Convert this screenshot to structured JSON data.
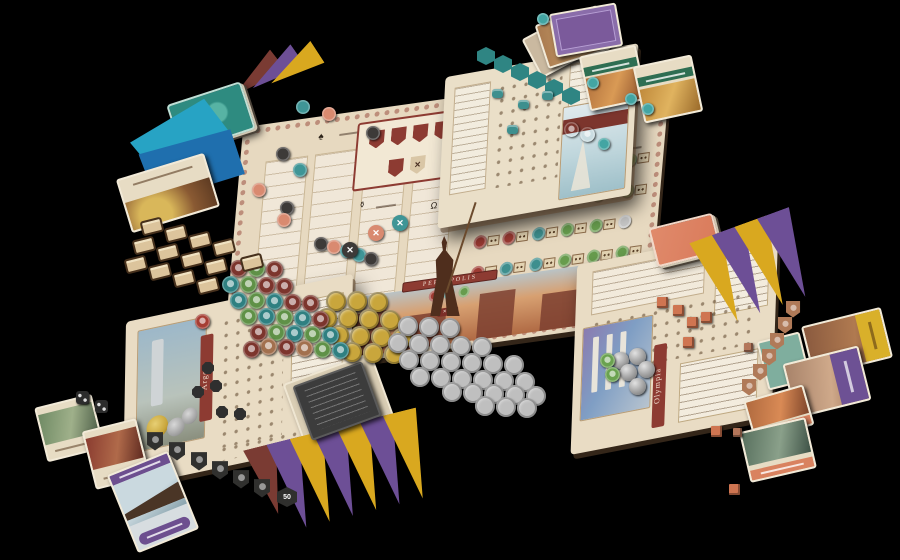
{
  "scene": {
    "background": "#000000",
    "description": "tabletop photo of a strategy board game with main board, three city player boards, cards, pennants, coins and tokens"
  },
  "main_board": {
    "banner_label": "PERSEPOLIS",
    "multiplier_label": "×5",
    "shield_slots": 6,
    "icons": {
      "column": "♠",
      "tax": "⚱",
      "debts": "Ω",
      "expense": "✕"
    },
    "colors": {
      "red": "#9e3b33",
      "teal": "#3e8f8e",
      "green": "#679c4d",
      "silver": "#c6c6c6"
    },
    "market": {
      "rows": [
        [
          "r",
          "r",
          "s",
          "t",
          "_",
          "_"
        ],
        [
          "r",
          "r",
          "t",
          "t",
          "s",
          "g"
        ],
        [
          "r",
          "s",
          "t",
          "t",
          "g",
          "g"
        ],
        [
          "r",
          "r",
          "t",
          "g",
          "g",
          "s"
        ],
        [
          "r",
          "t",
          "t",
          "g",
          "g",
          "g"
        ]
      ]
    }
  },
  "player_boards": {
    "argos": {
      "name": "Argos",
      "banner_color": "#8d3b32",
      "piece_color": "#2f2f2f"
    },
    "olympia": {
      "name": "Olympia",
      "banner_color": "#8d3b32",
      "piece_color": "#cf7551"
    },
    "harbor": {
      "name": "",
      "piece_color": "#3e8f8e"
    }
  },
  "pennants": {
    "palette": {
      "purple": "#6d4f96",
      "yellow": "#d9a81f",
      "maroon": "#7a3b33"
    },
    "bottom": [
      "maroon",
      "purple",
      "yellow",
      "purple",
      "yellow",
      "purple",
      "yellow"
    ],
    "right": [
      "yellow",
      "purple",
      "yellow",
      "purple"
    ],
    "stack_top_left": [
      "maroon",
      "purple",
      "yellow"
    ]
  },
  "clusters": [
    {
      "name": "gold-coin",
      "shape": "coin",
      "size": 20,
      "color": "#c9a63c",
      "items": [
        [
          336,
          301
        ],
        [
          357,
          301
        ],
        [
          378,
          302
        ],
        [
          327,
          318
        ],
        [
          348,
          318
        ],
        [
          369,
          319
        ],
        [
          390,
          320
        ],
        [
          339,
          335
        ],
        [
          360,
          336
        ],
        [
          381,
          337
        ],
        [
          402,
          338
        ],
        [
          352,
          352
        ],
        [
          373,
          353
        ],
        [
          394,
          354
        ]
      ]
    },
    {
      "name": "silver-coin",
      "shape": "coin",
      "size": 20,
      "color": "#bfbfbf",
      "items": [
        [
          408,
          326
        ],
        [
          429,
          327
        ],
        [
          450,
          328
        ],
        [
          398,
          343
        ],
        [
          419,
          344
        ],
        [
          440,
          345
        ],
        [
          461,
          346
        ],
        [
          482,
          347
        ],
        [
          409,
          360
        ],
        [
          430,
          361
        ],
        [
          451,
          362
        ],
        [
          472,
          363
        ],
        [
          493,
          364
        ],
        [
          514,
          365
        ],
        [
          420,
          377
        ],
        [
          441,
          378
        ],
        [
          462,
          379
        ],
        [
          483,
          380
        ],
        [
          504,
          381
        ],
        [
          525,
          382
        ],
        [
          452,
          392
        ],
        [
          473,
          393
        ],
        [
          494,
          394
        ],
        [
          515,
          395
        ],
        [
          536,
          396
        ],
        [
          485,
          406
        ],
        [
          506,
          407
        ],
        [
          527,
          408
        ]
      ]
    },
    {
      "name": "helmet-token",
      "shape": "disc glyphed",
      "size": 17,
      "colors": {
        "m": "#7c352d",
        "t": "#2f8081",
        "g": "#5f9147",
        "c": "#a2704e"
      },
      "items": [
        [
          238,
          268,
          "m"
        ],
        [
          256,
          268,
          "g"
        ],
        [
          274,
          269,
          "m"
        ],
        [
          230,
          284,
          "t"
        ],
        [
          248,
          284,
          "g"
        ],
        [
          266,
          285,
          "m"
        ],
        [
          284,
          286,
          "m"
        ],
        [
          238,
          300,
          "t"
        ],
        [
          256,
          300,
          "g"
        ],
        [
          274,
          301,
          "t"
        ],
        [
          292,
          302,
          "m"
        ],
        [
          310,
          303,
          "m"
        ],
        [
          248,
          316,
          "g"
        ],
        [
          266,
          316,
          "t"
        ],
        [
          284,
          317,
          "g"
        ],
        [
          302,
          318,
          "t"
        ],
        [
          320,
          319,
          "m"
        ],
        [
          258,
          332,
          "m"
        ],
        [
          276,
          332,
          "g"
        ],
        [
          294,
          333,
          "t"
        ],
        [
          312,
          334,
          "g"
        ],
        [
          330,
          335,
          "t"
        ],
        [
          286,
          347,
          "m"
        ],
        [
          304,
          348,
          "c"
        ],
        [
          322,
          349,
          "g"
        ],
        [
          340,
          350,
          "t"
        ],
        [
          268,
          346,
          "c"
        ],
        [
          251,
          349,
          "m"
        ]
      ]
    },
    {
      "name": "scroll-token",
      "shape": "scroll",
      "w": 22,
      "h": 15,
      "color": "#dcc49c",
      "items": [
        [
          152,
          226
        ],
        [
          176,
          233
        ],
        [
          200,
          240
        ],
        [
          224,
          247
        ],
        [
          144,
          245
        ],
        [
          168,
          252
        ],
        [
          192,
          259
        ],
        [
          216,
          266
        ],
        [
          136,
          264
        ],
        [
          160,
          271
        ],
        [
          184,
          278
        ],
        [
          208,
          285
        ],
        [
          252,
          262
        ]
      ]
    },
    {
      "name": "track-disc",
      "shape": "disc",
      "size": 14,
      "colors": {
        "t": "#3f9596",
        "s": "#d98a70",
        "k": "#3d3a38"
      },
      "items": [
        [
          303,
          107,
          "t"
        ],
        [
          329,
          114,
          "s"
        ],
        [
          373,
          133,
          "k"
        ],
        [
          283,
          154,
          "k"
        ],
        [
          300,
          170,
          "t"
        ],
        [
          259,
          190,
          "s"
        ],
        [
          287,
          208,
          "k"
        ],
        [
          284,
          220,
          "s"
        ],
        [
          321,
          244,
          "k"
        ],
        [
          334,
          247,
          "s"
        ],
        [
          347,
          251,
          "t"
        ],
        [
          359,
          255,
          "t"
        ],
        [
          371,
          259,
          "k"
        ]
      ]
    },
    {
      "name": "x-token",
      "shape": "xdisc",
      "size": 16,
      "glyph": "✕",
      "colors": {
        "t": "#3f9596",
        "s": "#d98a70",
        "k": "#3d3a38"
      },
      "items": [
        [
          400,
          223,
          "t"
        ],
        [
          376,
          233,
          "s"
        ],
        [
          350,
          250,
          "k"
        ]
      ]
    },
    {
      "name": "teal-hex-token",
      "shape": "hex",
      "size": 18,
      "color": "#2f8583",
      "items": [
        [
          486,
          56
        ],
        [
          503,
          64
        ],
        [
          520,
          72
        ],
        [
          537,
          80
        ],
        [
          554,
          88
        ],
        [
          571,
          96
        ]
      ]
    },
    {
      "name": "teal-gem",
      "shape": "disc",
      "size": 12,
      "colors": {
        "t": "#43a5a3"
      },
      "items": [
        [
          543,
          19,
          "t"
        ],
        [
          593,
          83,
          "t"
        ],
        [
          631,
          99,
          "t"
        ],
        [
          648,
          109,
          "t"
        ],
        [
          604,
          144,
          "t"
        ]
      ]
    },
    {
      "name": "black-shield-token",
      "shape": "shieldtok",
      "w": 17,
      "h": 19,
      "color": "#30302e",
      "items": [
        [
          155,
          441
        ],
        [
          177,
          451
        ],
        [
          199,
          461
        ],
        [
          220,
          470
        ],
        [
          241,
          479
        ],
        [
          262,
          488
        ]
      ]
    },
    {
      "name": "black-die",
      "shape": "die",
      "size": 13,
      "color": "#2c2c2c",
      "items": [
        [
          82,
          397
        ],
        [
          101,
          406
        ]
      ]
    },
    {
      "name": "value-hex-token",
      "shape": "hexlabel",
      "size": 20,
      "color": "#2f2f2d",
      "label": "50",
      "items": [
        [
          287,
          497
        ]
      ]
    },
    {
      "name": "copper-shield-token",
      "shape": "shieldtok",
      "w": 15,
      "h": 17,
      "color": "#b07a58",
      "items": [
        [
          793,
          309
        ],
        [
          785,
          325
        ],
        [
          777,
          341
        ],
        [
          769,
          357
        ],
        [
          760,
          372
        ],
        [
          749,
          387
        ]
      ]
    },
    {
      "name": "orange-cube",
      "shape": "cube",
      "size": 11,
      "color": "#cf7551",
      "items": [
        [
          662,
          302
        ],
        [
          678,
          310
        ],
        [
          692,
          322
        ],
        [
          706,
          317
        ],
        [
          688,
          342
        ],
        [
          716,
          431
        ],
        [
          734,
          489
        ]
      ]
    },
    {
      "name": "copper-square-token",
      "shape": "cube",
      "size": 9,
      "color": "#b3765a",
      "items": [
        [
          748,
          347
        ],
        [
          737,
          432
        ]
      ]
    },
    {
      "name": "black-octagon-piece",
      "shape": "oct",
      "size": 12,
      "color": "#2f2f2f",
      "items": [
        [
          208,
          368
        ],
        [
          216,
          386
        ],
        [
          198,
          392
        ],
        [
          222,
          412
        ],
        [
          240,
          414
        ]
      ]
    },
    {
      "name": "silver-sphere",
      "shape": "sphere",
      "size": 17,
      "color": "#a0a0a0",
      "items": [
        [
          620,
          360
        ],
        [
          637,
          356
        ],
        [
          628,
          372
        ],
        [
          646,
          369
        ],
        [
          637,
          386
        ]
      ]
    },
    {
      "name": "green-disc",
      "shape": "disc glyphed",
      "size": 15,
      "colors": {
        "g": "#6aa24f"
      },
      "items": [
        [
          607,
          360,
          "g"
        ],
        [
          612,
          374,
          "g"
        ]
      ]
    },
    {
      "name": "argos-red-disc",
      "shape": "disc glyphed",
      "size": 15,
      "colors": {
        "r": "#a63d33"
      },
      "items": [
        [
          202,
          321,
          "r"
        ]
      ]
    },
    {
      "name": "teal-cylinder",
      "shape": "cyl",
      "w": 11,
      "h": 9,
      "color": "#3e8f8e",
      "items": [
        [
          497,
          93
        ],
        [
          523,
          104
        ],
        [
          547,
          95
        ],
        [
          512,
          129
        ]
      ]
    },
    {
      "name": "harbor-beam-disc",
      "shape": "disc glyphed",
      "size": 15,
      "colors": {
        "t": "#3f9596"
      },
      "items": [
        [
          571,
          129
        ],
        [
          587,
          134
        ]
      ]
    }
  ]
}
